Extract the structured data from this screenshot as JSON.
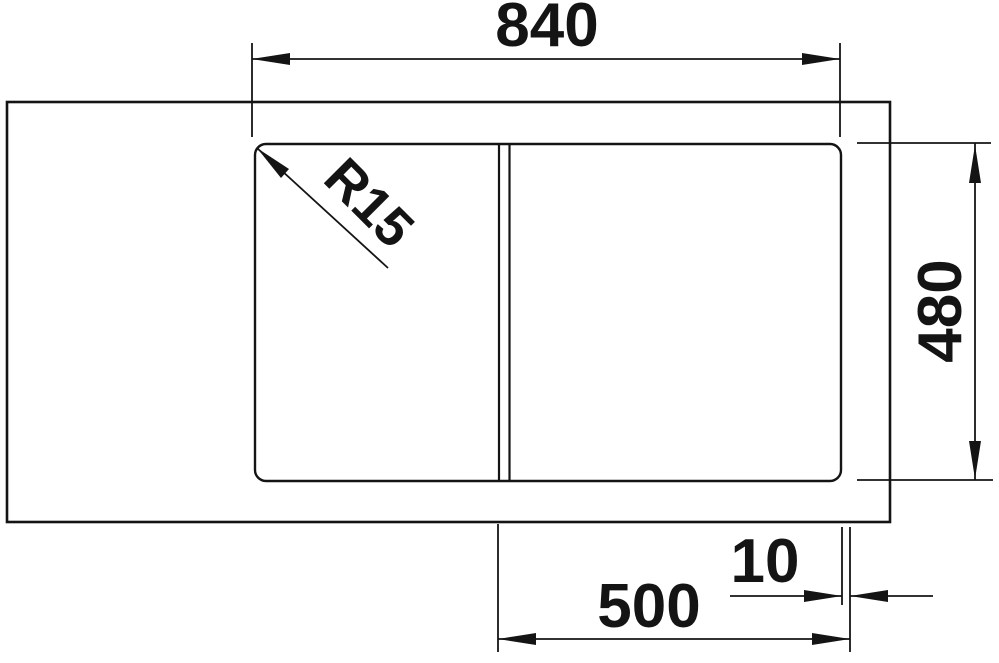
{
  "diagram": {
    "description": "Technical top-view dimension drawing of a rectangular inset sink with rounded-corner bowl area and vertical divider",
    "labels": {
      "overall_width": "840",
      "overall_depth": "480",
      "corner_radius": "R15",
      "bowl_width": "500",
      "edge_offset": "10"
    },
    "colors": {
      "ink": "#141414",
      "background": "#ffffff"
    }
  }
}
